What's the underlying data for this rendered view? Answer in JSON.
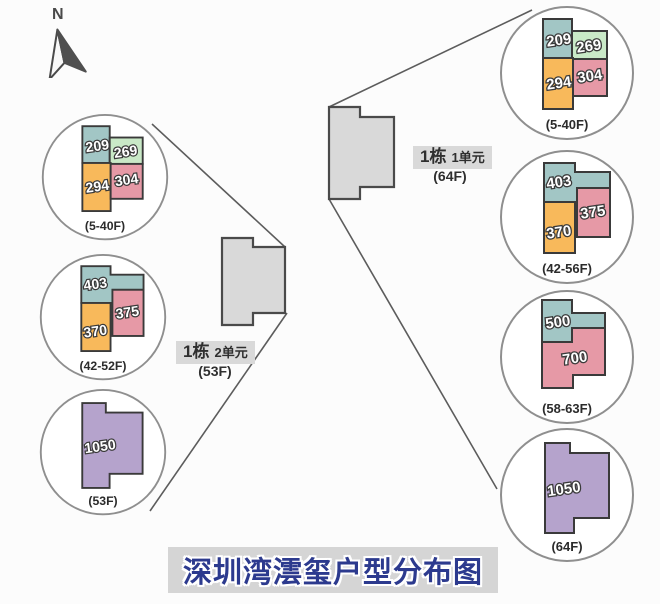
{
  "title": "深圳湾澐玺户型分布图",
  "compass": {
    "label": "N"
  },
  "buildings": {
    "left": {
      "name": "1栋",
      "unit": "2单元",
      "floors": "(53F)"
    },
    "right": {
      "name": "1栋",
      "unit": "1单元",
      "floors": "(64F)"
    }
  },
  "left_circles": [
    {
      "floors": "(5-40F)",
      "units": {
        "teal": "209",
        "green": "269",
        "orange": "294",
        "pink": "304"
      }
    },
    {
      "floors": "(42-52F)",
      "units": {
        "teal": "403",
        "pink": "375",
        "orange": "370"
      }
    },
    {
      "floors": "(53F)",
      "units": {
        "purple": "1050"
      }
    }
  ],
  "right_circles": [
    {
      "floors": "(5-40F)",
      "units": {
        "teal": "209",
        "green": "269",
        "orange": "294",
        "pink": "304"
      }
    },
    {
      "floors": "(42-56F)",
      "units": {
        "teal": "403",
        "pink": "375",
        "orange": "370"
      }
    },
    {
      "floors": "(58-63F)",
      "units": {
        "teal": "500",
        "pink": "700"
      }
    },
    {
      "floors": "(64F)",
      "units": {
        "purple": "1050"
      }
    }
  ],
  "colors": {
    "teal": "#a2c6c5",
    "green": "#c9e9c7",
    "orange": "#f8b95b",
    "pink": "#e699a6",
    "purple": "#b5a3cc",
    "building": "#d9d9d9",
    "title_blue": "#2c3a8e"
  }
}
